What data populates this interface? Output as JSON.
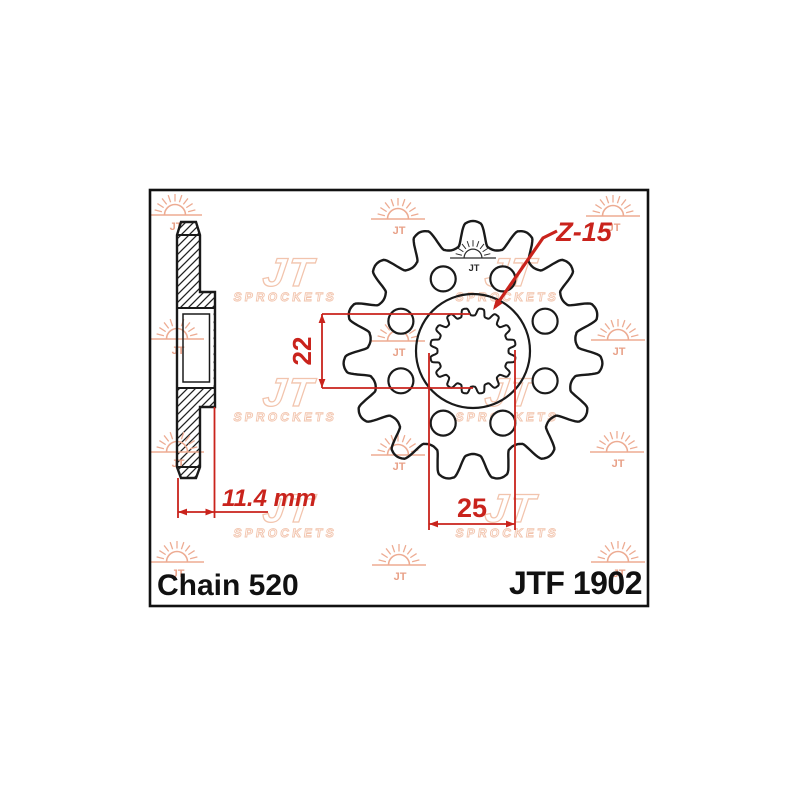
{
  "drawing": {
    "labels": {
      "teeth_count": "Z-15",
      "bore_minor": "22",
      "bore_major": "25",
      "offset_width": "11.4 mm",
      "chain": "Chain 520",
      "part_number": "JTF 1902"
    },
    "watermark": {
      "brand": "JT",
      "sub": "SPROCKETS"
    },
    "colors": {
      "ink": "#1a1a1a",
      "dim": "#c9231c",
      "watermark_sun": "#edab92",
      "watermark_logo": "#f2c4ad",
      "stamp": "#2a2a2a",
      "background": "#ffffff"
    },
    "geometry": {
      "border": {
        "x": 150,
        "y": 190,
        "width": 498,
        "height": 416
      },
      "front_view": {
        "cx": 473,
        "cy": 351,
        "teeth": 15,
        "tip_radius": 130,
        "root_radius": 103,
        "hub_radius": 57,
        "hole_ring_radius": 78,
        "hole_radius": 12.5,
        "hole_count": 8,
        "hole_start_angle": 22.5,
        "spline_teeth": 16,
        "spline_outer_radius": 43,
        "spline_inner_radius": 35.5
      },
      "side_view": {
        "left": 177,
        "body_right": 200,
        "hub_right": 215,
        "top": 222,
        "bottom": 478,
        "tip_inset": 4,
        "tip_base_top": 235,
        "hub_top": 292,
        "hub_bottom": 407,
        "tip_base_bottom": 467,
        "bore_top": 308,
        "bore_bottom": 388
      },
      "stamp_pos": [
        473,
        258
      ],
      "watermark_suns": [
        [
          175,
          215
        ],
        [
          398,
          219
        ],
        [
          613,
          216
        ],
        [
          177,
          339
        ],
        [
          398,
          341
        ],
        [
          618,
          340
        ],
        [
          177,
          452
        ],
        [
          398,
          455
        ],
        [
          617,
          452
        ],
        [
          177,
          562
        ],
        [
          399,
          565
        ],
        [
          618,
          562
        ]
      ],
      "watermark_logos": [
        [
          288,
          278
        ],
        [
          510,
          278
        ],
        [
          288,
          398
        ],
        [
          510,
          398
        ],
        [
          288,
          514
        ],
        [
          510,
          514
        ]
      ]
    }
  }
}
